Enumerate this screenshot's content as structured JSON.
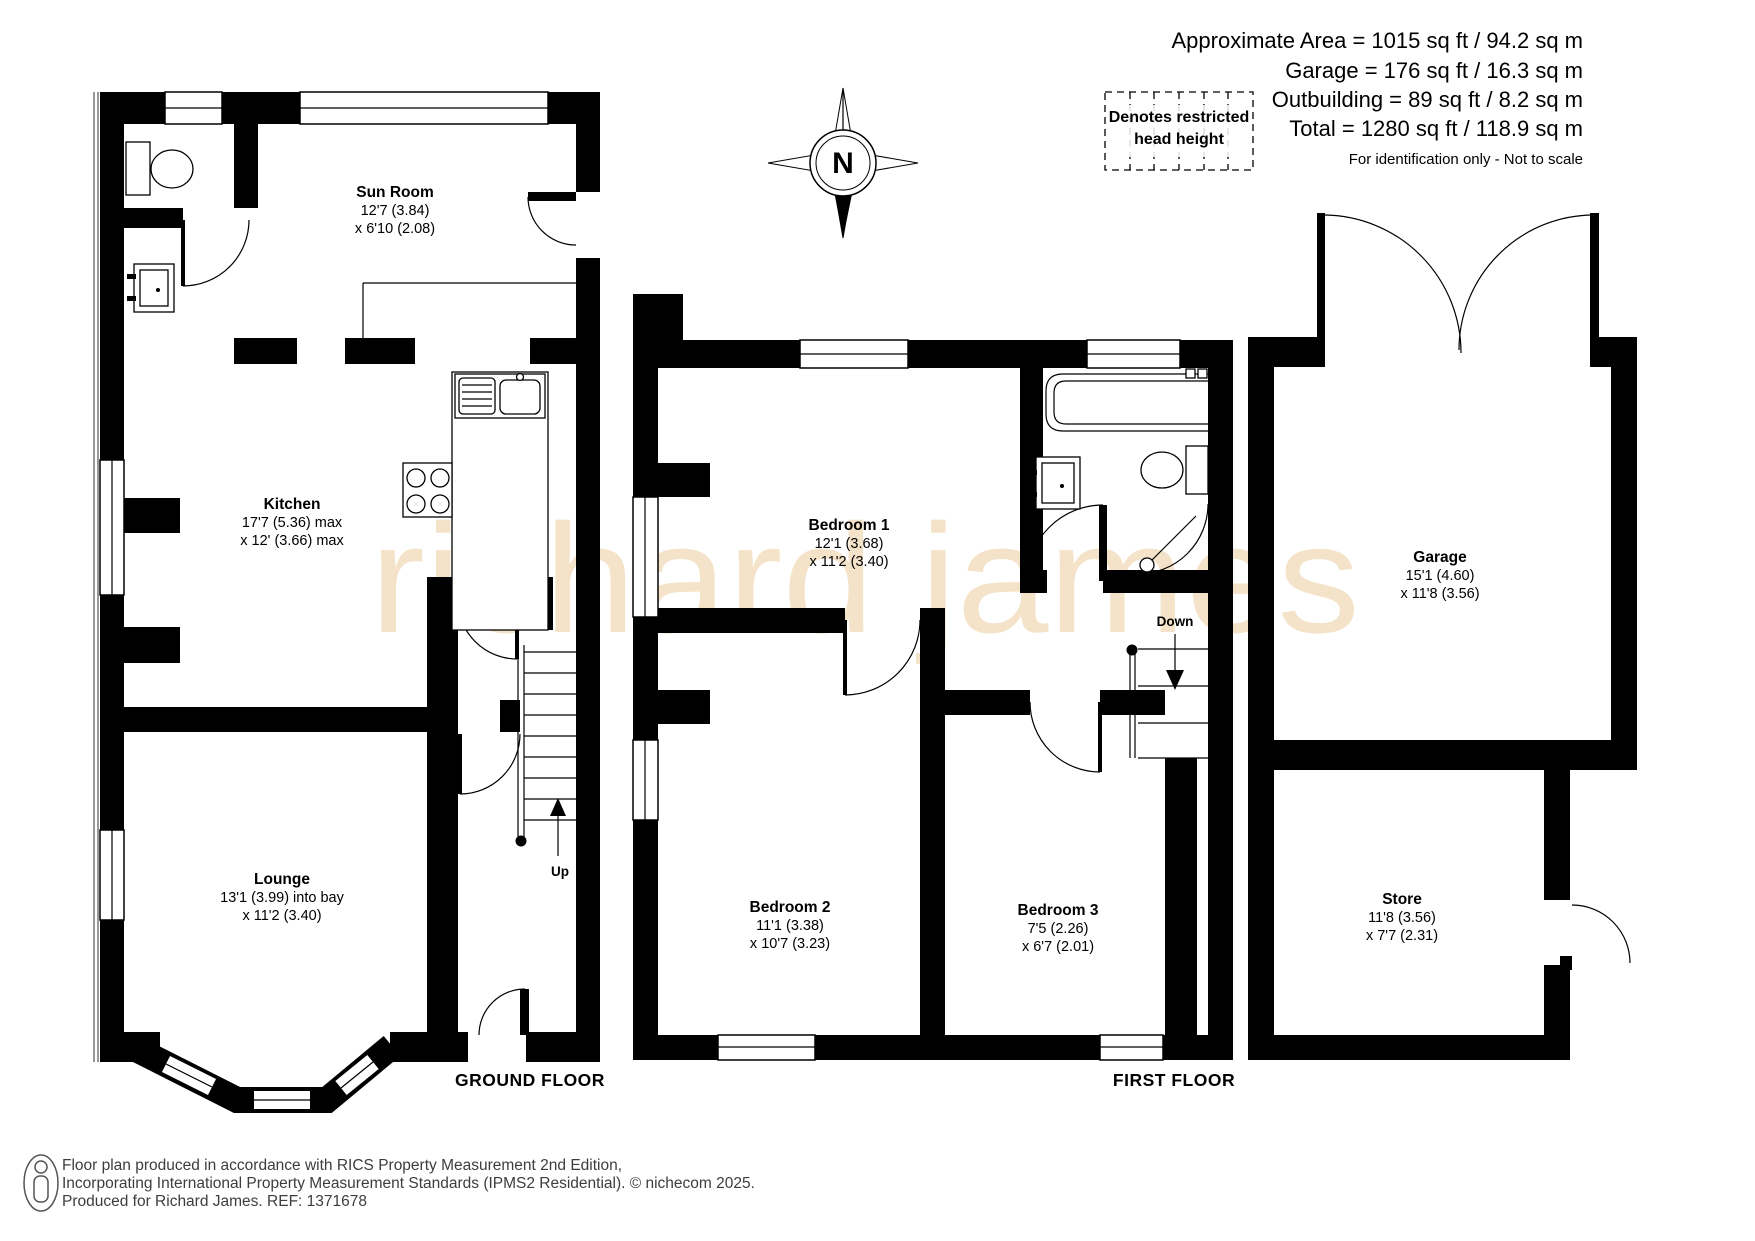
{
  "header": {
    "area_lines": [
      "Approximate Area = 1015 sq ft / 94.2 sq m",
      "Garage = 176 sq ft / 16.3 sq m",
      "Outbuilding = 89 sq ft / 8.2 sq m",
      "Total = 1280 sq ft / 118.9 sq m"
    ],
    "scale_note": "For identification only - Not to scale",
    "legend_line1": "Denotes restricted",
    "legend_line2": "head height",
    "compass": "N"
  },
  "rooms": {
    "sun_room": {
      "name": "Sun Room",
      "dim1": "12'7 (3.84)",
      "dim2": "x 6'10 (2.08)"
    },
    "kitchen": {
      "name": "Kitchen",
      "dim1": "17'7 (5.36) max",
      "dim2": "x 12' (3.66) max"
    },
    "lounge": {
      "name": "Lounge",
      "dim1": "13'1 (3.99) into bay",
      "dim2": "x 11'2 (3.40)"
    },
    "bedroom1": {
      "name": "Bedroom 1",
      "dim1": "12'1 (3.68)",
      "dim2": "x 11'2 (3.40)"
    },
    "bedroom2": {
      "name": "Bedroom 2",
      "dim1": "11'1 (3.38)",
      "dim2": "x 10'7 (3.23)"
    },
    "bedroom3": {
      "name": "Bedroom 3",
      "dim1": "7'5 (2.26)",
      "dim2": "x 6'7 (2.01)"
    },
    "garage": {
      "name": "Garage",
      "dim1": "15'1 (4.60)",
      "dim2": "x 11'8 (3.56)"
    },
    "store": {
      "name": "Store",
      "dim1": "11'8 (3.56)",
      "dim2": "x 7'7 (2.31)"
    }
  },
  "floor_labels": {
    "ground": "GROUND FLOOR",
    "first": "FIRST FLOOR"
  },
  "stairs": {
    "up": "Up",
    "down": "Down"
  },
  "watermark": "richard james",
  "footer": {
    "line1": "Floor plan produced in accordance with RICS Property Measurement 2nd Edition,",
    "line2": "Incorporating International Property Measurement Standards (IPMS2 Residential).   © nichecom 2025.",
    "line3": "Produced for Richard James.   REF:  1371678"
  },
  "colors": {
    "wall": "#000000",
    "watermark": "#f4e3c8",
    "footer_text": "#3d3d3d"
  }
}
